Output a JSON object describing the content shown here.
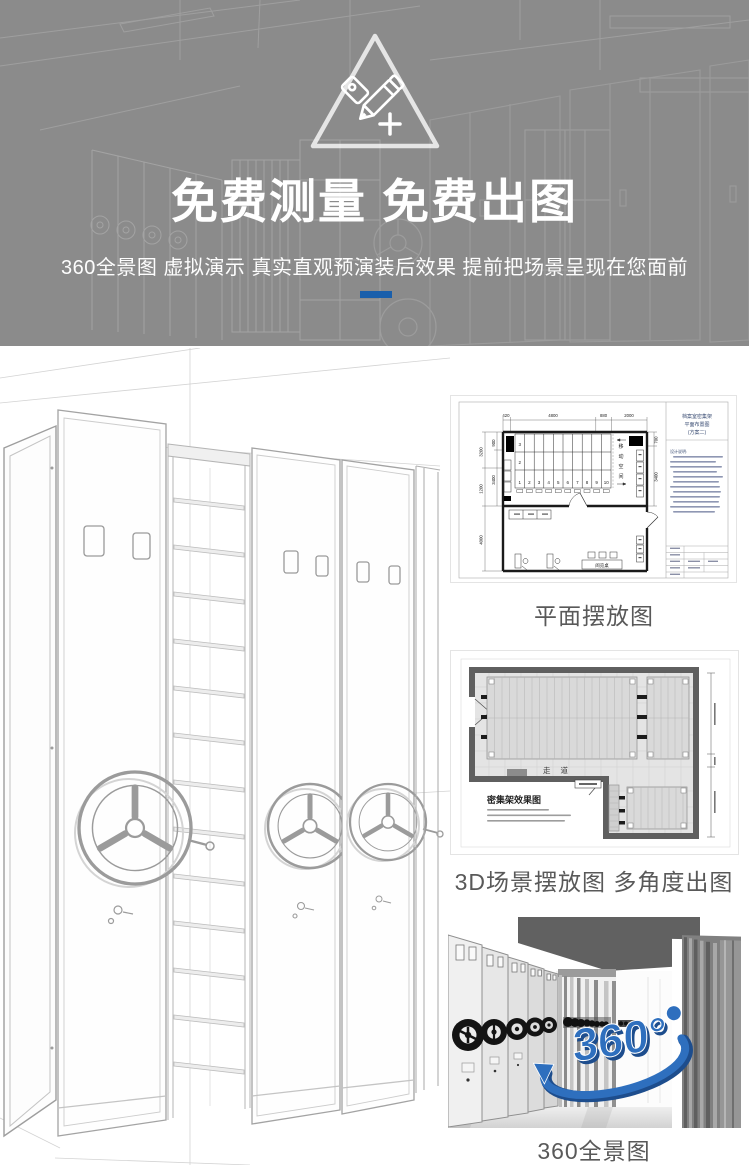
{
  "banner": {
    "title": "免费测量 免费出图",
    "subtitle": "360全景图 虚拟演示 真实直观预演装后效果 提前把场景呈现在您面前",
    "background_color": "#8b8b8b",
    "accent_bar_color": "#1a5fab"
  },
  "gallery": {
    "floor_plan": {
      "caption": "平面摆放图",
      "title_block": {
        "line1": "档案室密集架",
        "line2": "平面布置图",
        "line3": "(方案二)",
        "note_heading": "设计说明:"
      },
      "dims_top": [
        "420",
        "4800",
        "880",
        "2000"
      ],
      "dims_left": [
        "900",
        "3200",
        "3400",
        "1200",
        "4000"
      ],
      "dims_right": [
        "700",
        "3400"
      ],
      "bay_numbers": [
        "1",
        "2",
        "3",
        "4",
        "5",
        "6",
        "7",
        "8",
        "9",
        "10"
      ],
      "row_numbers": [
        "3",
        "2"
      ],
      "movement_chars": [
        "移",
        "动",
        "空",
        "间"
      ],
      "reading_desk_label": "阅览桌"
    },
    "scene_plan": {
      "caption": "3D场景摆放图 多角度出图",
      "drawing_title": "密集架效果图",
      "corridor_label": "走道"
    },
    "panorama": {
      "caption": "360全景图",
      "logo_text": "360°",
      "logo_color": "#2e6fbe"
    }
  }
}
